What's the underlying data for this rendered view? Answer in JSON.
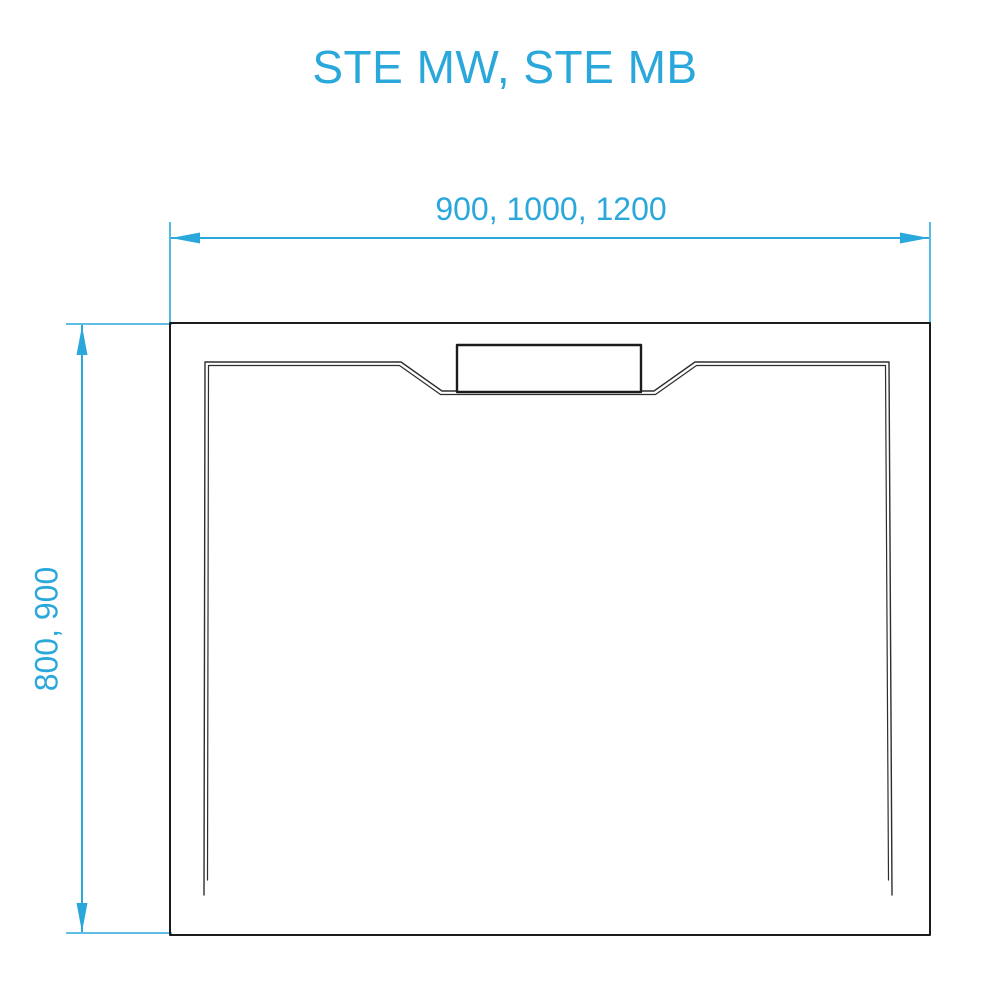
{
  "title": "STE MW, STE MB",
  "drawing": {
    "type": "technical-dimension-drawing",
    "subject": "shower-tray-top-view",
    "width_dimension_label": "900, 1000, 1200",
    "height_dimension_label": "800, 900"
  },
  "colors": {
    "accent": "#2BA8DB",
    "line_dark": "#1C1C1C",
    "line_inner": "#2E2E2E",
    "background": "#FFFFFF"
  }
}
